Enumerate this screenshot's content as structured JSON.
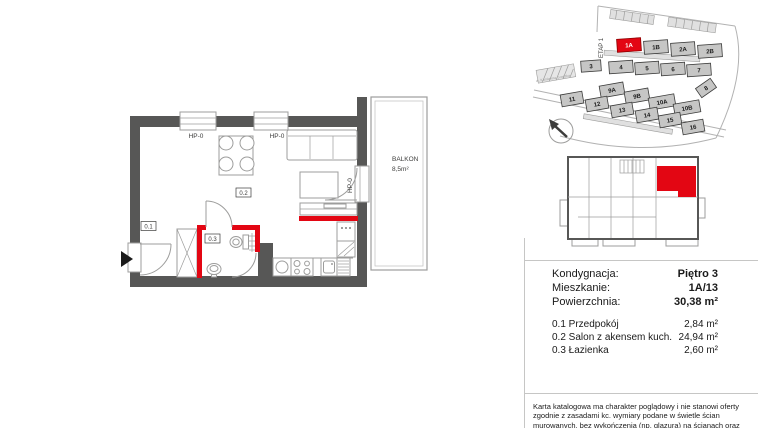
{
  "colors": {
    "red": "#e30613",
    "wall": "#575756",
    "line": "#9d9d9c"
  },
  "main_plan": {
    "window1_label": "HP-0",
    "window2_label": "HP-0",
    "balcony_door_label": "HP-0",
    "balcony_name": "BALKON",
    "balcony_area": "8,5m²",
    "room_hall": "0.1",
    "room_salon": "0.2",
    "room_bath": "0.3"
  },
  "site_plan": {
    "etap": "ETAP 1",
    "street": "ul. Kamienna Grodzka",
    "buildings": [
      {
        "label": "1A"
      },
      {
        "label": "1B"
      },
      {
        "label": "2A"
      },
      {
        "label": "2B"
      },
      {
        "label": "3"
      },
      {
        "label": "4"
      },
      {
        "label": "5"
      },
      {
        "label": "6"
      },
      {
        "label": "7"
      },
      {
        "label": "9A"
      },
      {
        "label": "9B"
      },
      {
        "label": "10A"
      },
      {
        "label": "10B"
      },
      {
        "label": "8"
      },
      {
        "label": "11"
      },
      {
        "label": "12"
      },
      {
        "label": "13"
      },
      {
        "label": "14"
      },
      {
        "label": "15"
      },
      {
        "label": "16"
      }
    ]
  },
  "info": {
    "rows": [
      {
        "label": "Kondygnacja:",
        "value": "Piętro 3"
      },
      {
        "label": "Mieszkanie:",
        "value": "1A/13"
      },
      {
        "label": "Powierzchnia:",
        "value": "30,38 m²"
      }
    ],
    "rooms": [
      {
        "name": "0.1 Przedpokój",
        "area": "2,84 m²"
      },
      {
        "name": "0.2 Salon z akensem kuch.",
        "area": "24,94 m²"
      },
      {
        "name": "0.3 Łazienka",
        "area": "2,60 m²"
      }
    ]
  },
  "disclaimer": "Karta katalogowa ma charakter poglądowy i nie stanowi oferty zgodnie z zasadami kc. wymiary podane w świetle ścian  murowanych, bez wykończenia (np. glazura) na ścianach oraz posadzkach."
}
